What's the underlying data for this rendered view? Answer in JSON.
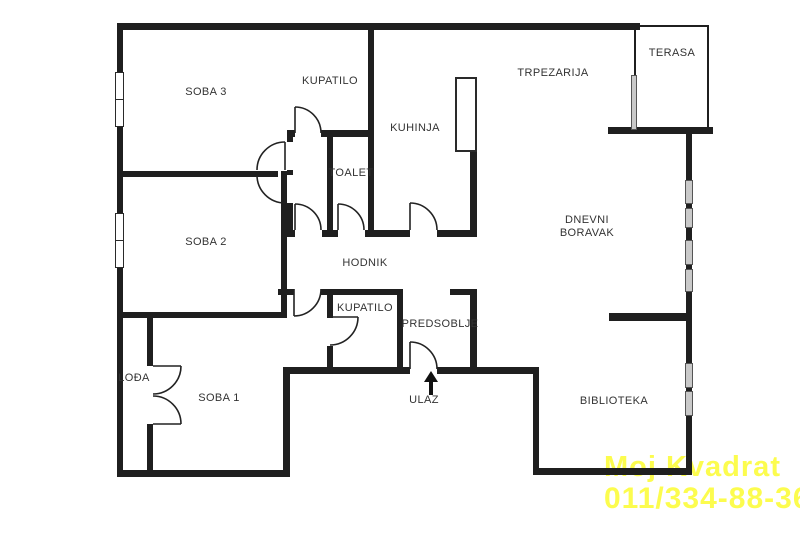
{
  "rooms": {
    "soba3": "SOBA 3",
    "kupatilo_top": "KUPATILO",
    "kuhinja": "KUHINJA",
    "trpezarija": "TRPEZARIJA",
    "terasa": "TERASA",
    "toalet": "TOALET",
    "dnevni_boravak": {
      "line1": "DNEVNI",
      "line2": "BORAVAK"
    },
    "soba2": "SOBA 2",
    "hodnik": "HODNIK",
    "kupatilo_bottom": "KUPATILO",
    "predsoblje": "PREDSOBLJE",
    "lodja": "LOĐA",
    "soba1": "SOBA 1",
    "ulaz": "ULAZ",
    "biblioteka": "BIBLIOTEKA"
  },
  "watermark": {
    "line1": "Moj Kvadrat",
    "line2": "011/334-88-36",
    "color": "#fcfc4e"
  },
  "colors": {
    "wall": "#1f1f1f",
    "window_glass": "#c9c9c9",
    "label_text": "#333333",
    "background": "#ffffff"
  },
  "icons": {
    "entrance_arrow": "up-arrow"
  }
}
